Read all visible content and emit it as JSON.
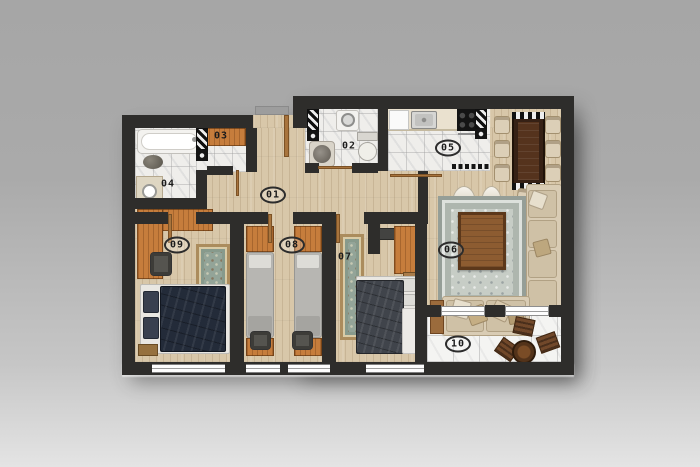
{
  "rooms": [
    {
      "label": "01"
    },
    {
      "label": "02"
    },
    {
      "label": "03"
    },
    {
      "label": "04"
    },
    {
      "label": "05"
    },
    {
      "label": "06"
    },
    {
      "label": "07"
    },
    {
      "label": "08"
    },
    {
      "label": "09"
    },
    {
      "label": "10"
    }
  ],
  "palette": {
    "wall": "#2e2d2b",
    "wood_floor": "#d8c7a9",
    "accent_wood": "#c67d3c",
    "marble": "#efeeeb",
    "balcony_tile": "#f4f4f2",
    "navy_bed": "#232b39",
    "charcoal_bed": "#40444b",
    "sofa_beige": "#d9ccb4",
    "rug_green": "#93a498",
    "rug_gray": "#c7cdc6",
    "dining_table": "#362115",
    "background_top": "#a6a6a6",
    "background_bottom": "#e4e4e4"
  }
}
